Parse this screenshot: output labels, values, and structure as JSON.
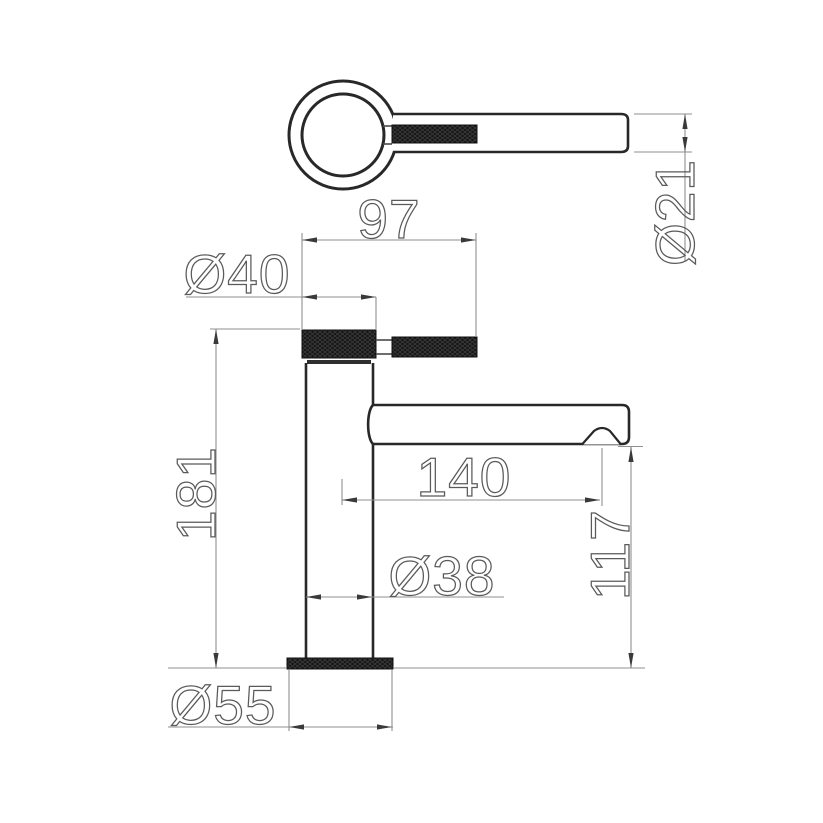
{
  "drawing": {
    "dimensions": {
      "handle_length": "97",
      "handle_cap_diameter": "Ø40",
      "lever_diameter": "Ø21",
      "overall_height": "181",
      "spout_reach": "140",
      "body_diameter": "Ø38",
      "spout_height": "117",
      "base_diameter": "Ø55"
    },
    "colors": {
      "object_line": "#282828",
      "dimension_line": "#8f8f8f",
      "text_outline": "#5a5a5a",
      "knurl_fill": "#161616",
      "background": "#ffffff"
    }
  }
}
